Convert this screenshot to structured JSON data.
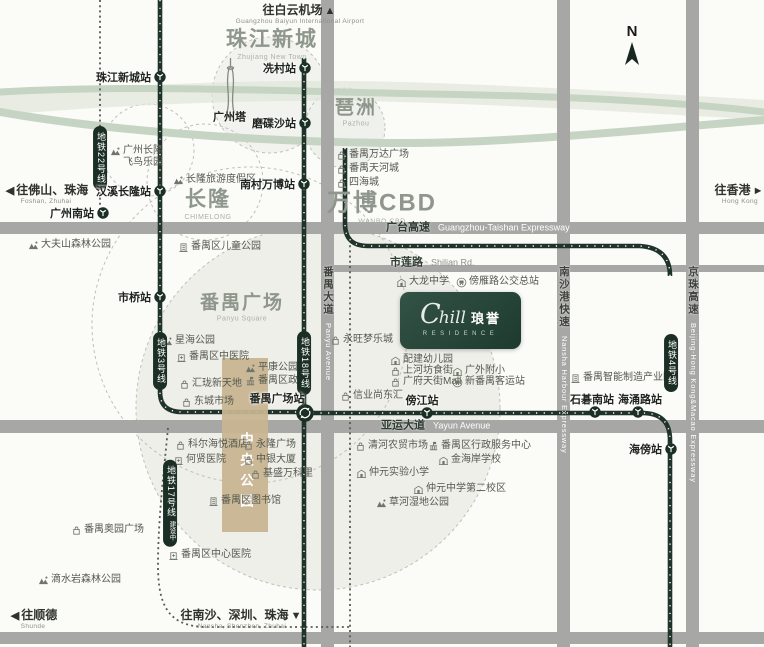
{
  "colors": {
    "metro": "#1f332a",
    "road": "#a7a7a5",
    "river": "#c6d4c3",
    "tan": "#c8b592",
    "logo_bg": "#24443a",
    "circle_fill": "#efefea",
    "area_text": "#8f978c"
  },
  "compass": {
    "label": "N"
  },
  "logo": {
    "script_c": "C",
    "script_rest": "hill",
    "cn": "琅誉",
    "sub": "RESIDENCE"
  },
  "central_park": {
    "label": "中央公园"
  },
  "areas": [
    {
      "cn": "珠江新城",
      "en": "Zhujiang New Town",
      "x": 272,
      "y": 42,
      "size": 21
    },
    {
      "cn": "琶洲",
      "en": "Pazhou",
      "x": 356,
      "y": 110,
      "size": 19
    },
    {
      "cn": "长隆",
      "en": "CHIMELONG",
      "x": 208,
      "y": 202,
      "size": 21
    },
    {
      "cn": "万博CBD",
      "en": "WANBO CBD",
      "x": 382,
      "y": 204,
      "size": 24
    },
    {
      "cn": "番禺广场",
      "en": "Panyu Square",
      "x": 242,
      "y": 305,
      "size": 19
    }
  ],
  "directions": [
    {
      "cn": "往白云机场",
      "en": "Guangzhou Baiyun International Airport",
      "arrow": "▲",
      "side": "after",
      "x": 300,
      "y": 13
    },
    {
      "cn": "往香港",
      "en": "Hong Kong",
      "arrow": "►",
      "side": "after",
      "x": 740,
      "y": 193
    },
    {
      "cn": "往佛山、珠海",
      "en": "Foshan, Zhuhai",
      "arrow": "◀",
      "side": "before",
      "x": 46,
      "y": 193
    },
    {
      "cn": "往顺德",
      "en": "Shunde",
      "arrow": "◀",
      "side": "before",
      "x": 33,
      "y": 618
    },
    {
      "cn": "往南沙、深圳、珠海",
      "en": "Nansha, Shenzhen, Zhuhai",
      "arrow": "▼",
      "side": "after",
      "x": 242,
      "y": 618
    }
  ],
  "road_labels": [
    {
      "cn": "广台高速",
      "en": "Guangzhou-Taishan Expressway",
      "x": 386,
      "y": 228,
      "style": "white-en"
    },
    {
      "cn": "市莲路",
      "en": "Shilian Rd.",
      "x": 390,
      "y": 263,
      "style": "gray-en"
    },
    {
      "cn": "亚运大道",
      "en": "Yayun Avenue",
      "x": 381,
      "y": 426,
      "style": "white-en"
    }
  ],
  "road_labels_vertical": [
    {
      "cn": "番禺大道",
      "en": "Panyu Avenue",
      "x": 328,
      "y": 266
    },
    {
      "cn": "南沙港快速",
      "en": "Nansha Harbour Expressway",
      "x": 564,
      "y": 266
    },
    {
      "cn": "京珠高速",
      "en": "Beijing-Hong Kong&Macao Expressway",
      "x": 693,
      "y": 266
    }
  ],
  "metro_labels": [
    {
      "t": "地铁22号线",
      "x": 100,
      "y": 158
    },
    {
      "t": "地铁3号线",
      "x": 160,
      "y": 361
    },
    {
      "t": "地铁18号线",
      "x": 304,
      "y": 363
    },
    {
      "t": "地铁17号线",
      "x": 170,
      "y": 503,
      "note": "建设中"
    },
    {
      "t": "地铁4号线",
      "x": 671,
      "y": 363
    }
  ],
  "stations": [
    {
      "n": "珠江新城站",
      "x": 160,
      "y": 77,
      "anchor": "left"
    },
    {
      "n": "冼村站",
      "x": 305,
      "y": 68,
      "anchor": "left"
    },
    {
      "n": "磨碟沙站",
      "x": 305,
      "y": 123,
      "anchor": "left"
    },
    {
      "n": "南村万博站",
      "x": 304,
      "y": 184,
      "anchor": "left"
    },
    {
      "n": "汉溪长隆站",
      "x": 160,
      "y": 191,
      "anchor": "left"
    },
    {
      "n": "广州南站",
      "x": 103,
      "y": 213,
      "anchor": "left"
    },
    {
      "n": "市桥站",
      "x": 160,
      "y": 297,
      "anchor": "left"
    },
    {
      "n": "番禺广场站",
      "x": 305,
      "y": 413,
      "lx": 277,
      "ly": 398,
      "anchor": "above",
      "type": "interchange"
    },
    {
      "n": "傍江站",
      "x": 427,
      "y": 413,
      "lx": 422,
      "ly": 400,
      "anchor": "above"
    },
    {
      "n": "石碁南站",
      "x": 595,
      "y": 412,
      "lx": 592,
      "ly": 399,
      "anchor": "above"
    },
    {
      "n": "海涌路站",
      "x": 638,
      "y": 412,
      "lx": 640,
      "ly": 399,
      "anchor": "above"
    },
    {
      "n": "海傍站",
      "x": 671,
      "y": 449,
      "anchor": "left"
    }
  ],
  "pois": [
    {
      "t": "番禺万达广场",
      "icon": "shop",
      "x": 336,
      "y": 155
    },
    {
      "t": "番禺天河城",
      "icon": "shop",
      "x": 336,
      "y": 169
    },
    {
      "t": "四海城",
      "icon": "shop",
      "x": 336,
      "y": 183
    },
    {
      "t": "广州长隆",
      "t2": "飞鸟乐园",
      "icon": "park",
      "x": 110,
      "y": 157
    },
    {
      "t": "长隆旅游度假区",
      "icon": "park",
      "x": 173,
      "y": 180
    },
    {
      "t": "大夫山森林公园",
      "icon": "park",
      "x": 28,
      "y": 245
    },
    {
      "t": "番禺区儿童公园",
      "icon": "building",
      "x": 178,
      "y": 247
    },
    {
      "t": "星海公园",
      "icon": "park",
      "x": 162,
      "y": 341
    },
    {
      "t": "番禺区中医院",
      "icon": "hospital",
      "x": 176,
      "y": 357
    },
    {
      "t": "平康公园",
      "icon": "park",
      "x": 245,
      "y": 368
    },
    {
      "t": "番禺区政府",
      "icon": "gov",
      "x": 245,
      "y": 381
    },
    {
      "t": "汇珑新天地",
      "icon": "shop",
      "x": 179,
      "y": 384
    },
    {
      "t": "东城市场",
      "icon": "shop",
      "x": 181,
      "y": 402
    },
    {
      "t": "永旺梦乐城",
      "icon": "shop",
      "x": 330,
      "y": 340
    },
    {
      "t": "配建幼儿园",
      "icon": "school",
      "x": 390,
      "y": 360
    },
    {
      "t": "上河坊食街",
      "icon": "shop",
      "x": 390,
      "y": 371
    },
    {
      "t": "广府天街Mall",
      "icon": "shop",
      "x": 390,
      "y": 382
    },
    {
      "t": "广外附小",
      "icon": "school",
      "x": 452,
      "y": 371
    },
    {
      "t": "新番禺客运站",
      "icon": "bus",
      "x": 452,
      "y": 382
    },
    {
      "t": "信业尚东汇",
      "icon": "shop",
      "x": 340,
      "y": 396
    },
    {
      "t": "大龙中学",
      "icon": "school",
      "x": 396,
      "y": 282
    },
    {
      "t": "傍雁路公交总站",
      "icon": "bus",
      "x": 456,
      "y": 282
    },
    {
      "t": "科尔海悦酒店",
      "icon": "shop",
      "x": 175,
      "y": 445
    },
    {
      "t": "永隆广场",
      "icon": "shop",
      "x": 243,
      "y": 445
    },
    {
      "t": "何贤医院",
      "icon": "hospital",
      "x": 173,
      "y": 460
    },
    {
      "t": "中银大厦",
      "icon": "shop",
      "x": 243,
      "y": 460
    },
    {
      "t": "基盛万科里",
      "icon": "shop",
      "x": 250,
      "y": 474
    },
    {
      "t": "番禺区图书馆",
      "icon": "building",
      "x": 208,
      "y": 501
    },
    {
      "t": "番禺区中心医院",
      "icon": "hospital",
      "x": 168,
      "y": 555
    },
    {
      "t": "番禺奥园广场",
      "icon": "shop",
      "x": 71,
      "y": 530
    },
    {
      "t": "滴水岩森林公园",
      "icon": "park",
      "x": 38,
      "y": 580
    },
    {
      "t": "清河农贸市场",
      "icon": "shop",
      "x": 355,
      "y": 446
    },
    {
      "t": "番禺区行政服务中心",
      "icon": "gov",
      "x": 428,
      "y": 446
    },
    {
      "t": "金海岸学校",
      "icon": "school",
      "x": 438,
      "y": 460
    },
    {
      "t": "仲元实验小学",
      "icon": "school",
      "x": 356,
      "y": 473
    },
    {
      "t": "仲元中学第二校区",
      "icon": "school",
      "x": 413,
      "y": 489
    },
    {
      "t": "草河湿地公园",
      "icon": "park",
      "x": 376,
      "y": 503
    },
    {
      "t": "番禺智能制造产业园",
      "icon": "building",
      "x": 570,
      "y": 378
    },
    {
      "t": "广州塔",
      "icon": "",
      "x": 213,
      "y": 118,
      "b": 1
    }
  ]
}
